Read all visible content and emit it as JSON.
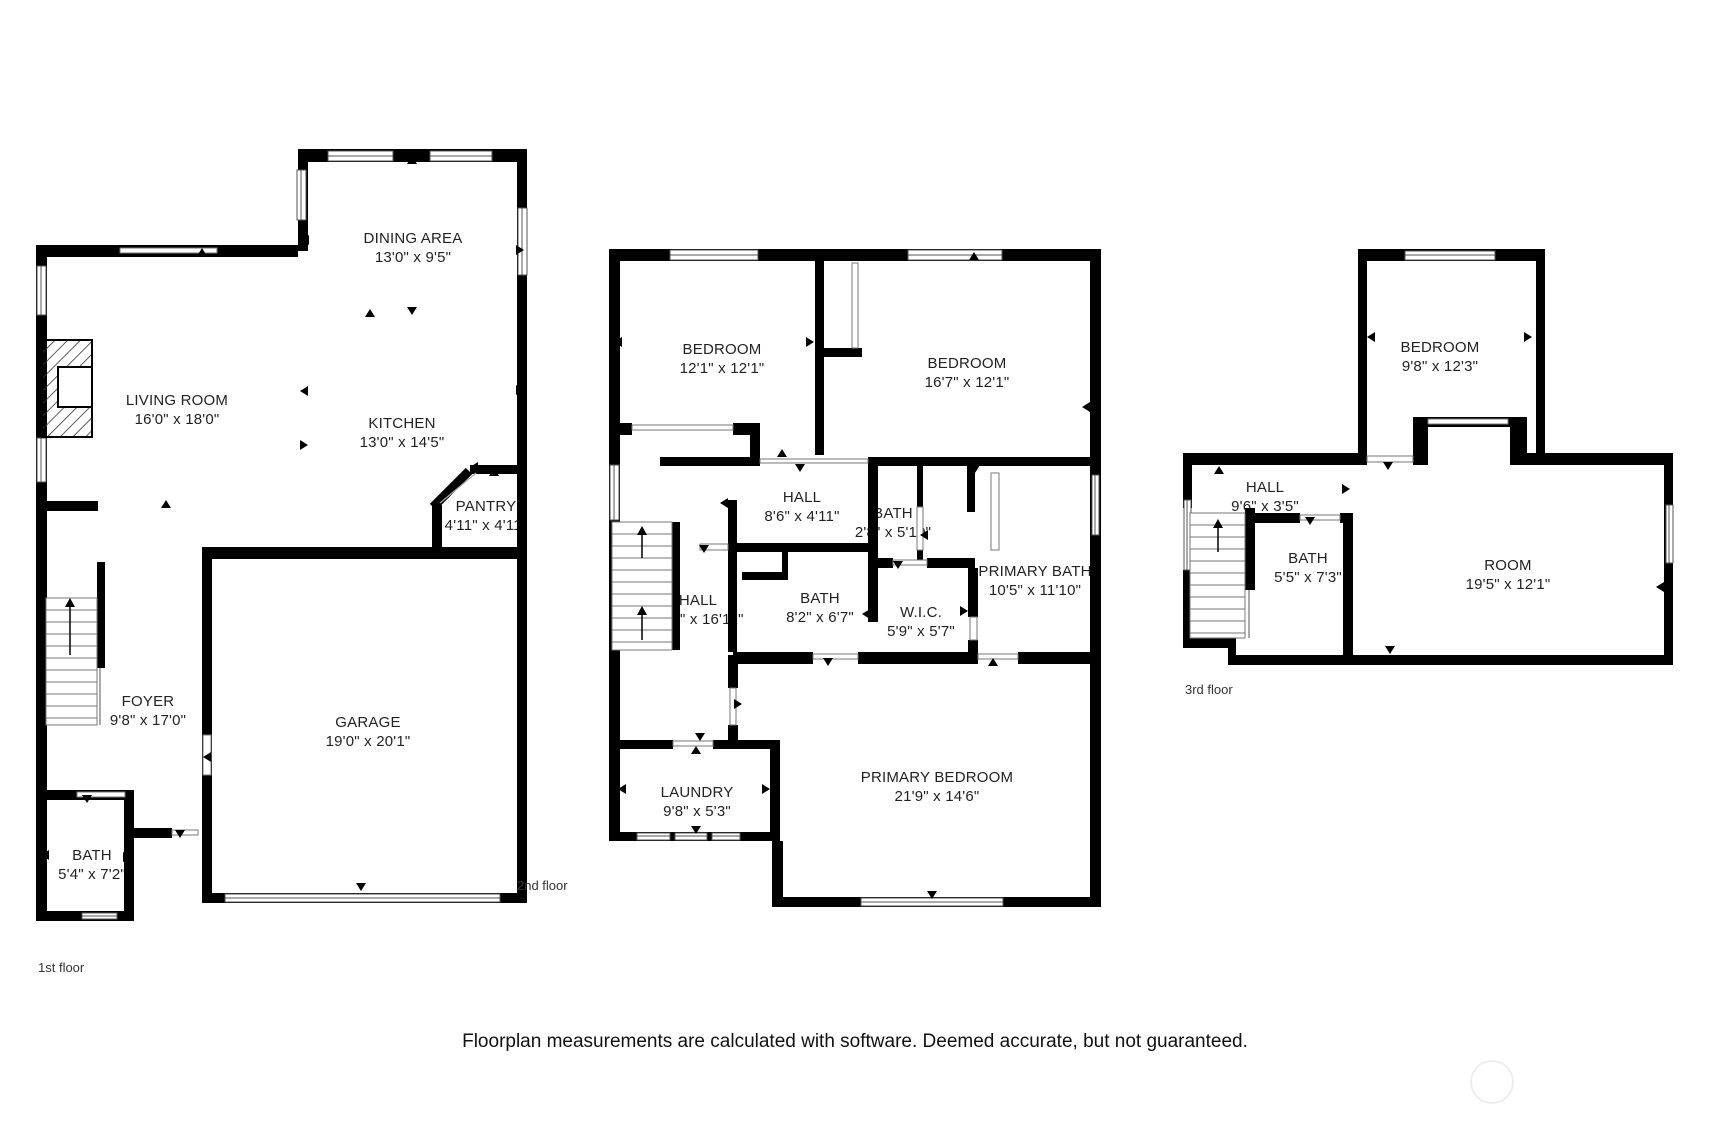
{
  "floors": [
    {
      "label": "1st floor",
      "rooms": {
        "dining": {
          "name": "DINING AREA",
          "dims": "13'0\" x 9'5\""
        },
        "living": {
          "name": "LIVING ROOM",
          "dims": "16'0\" x 18'0\""
        },
        "kitchen": {
          "name": "KITCHEN",
          "dims": "13'0\" x 14'5\""
        },
        "pantry": {
          "name": "PANTRY",
          "dims": "4'11\" x 4'11\""
        },
        "foyer": {
          "name": "FOYER",
          "dims": "9'8\" x 17'0\""
        },
        "garage": {
          "name": "GARAGE",
          "dims": "19'0\" x 20'1\""
        },
        "bath": {
          "name": "BATH",
          "dims": "5'4\" x 7'2\""
        }
      }
    },
    {
      "label": "2nd floor",
      "rooms": {
        "bedroom1": {
          "name": "BEDROOM",
          "dims": "12'1\" x 12'1\""
        },
        "bedroom2": {
          "name": "BEDROOM",
          "dims": "16'7\" x 12'1\""
        },
        "hall_a": {
          "name": "HALL",
          "dims": "8'6\" x 4'11\""
        },
        "bath_small": {
          "name": "BATH",
          "dims": "2'8\" x 5'10\""
        },
        "primary_bath": {
          "name": "PRIMARY BATH",
          "dims": "10'5\" x 11'10\""
        },
        "hall_b": {
          "name": "HALL",
          "dims": "6'11\" x 16'11\""
        },
        "bath": {
          "name": "BATH",
          "dims": "8'2\" x 6'7\""
        },
        "wic": {
          "name": "W.I.C.",
          "dims": "5'9\" x 5'7\""
        },
        "laundry": {
          "name": "LAUNDRY",
          "dims": "9'8\" x 5'3\""
        },
        "primary_bedroom": {
          "name": "PRIMARY BEDROOM",
          "dims": "21'9\" x 14'6\""
        }
      }
    },
    {
      "label": "3rd floor",
      "rooms": {
        "bedroom": {
          "name": "BEDROOM",
          "dims": "9'8\" x 12'3\""
        },
        "hall": {
          "name": "HALL",
          "dims": "9'6\" x 3'5\""
        },
        "bath": {
          "name": "BATH",
          "dims": "5'5\" x 7'3\""
        },
        "room": {
          "name": "ROOM",
          "dims": "19'5\" x 12'1\""
        }
      }
    }
  ],
  "disclaimer": "Floorplan measurements are calculated with software. Deemed accurate, but not guaranteed.",
  "colors": {
    "wall": "#000000",
    "background": "#ffffff",
    "text": "#1a1a1a"
  }
}
